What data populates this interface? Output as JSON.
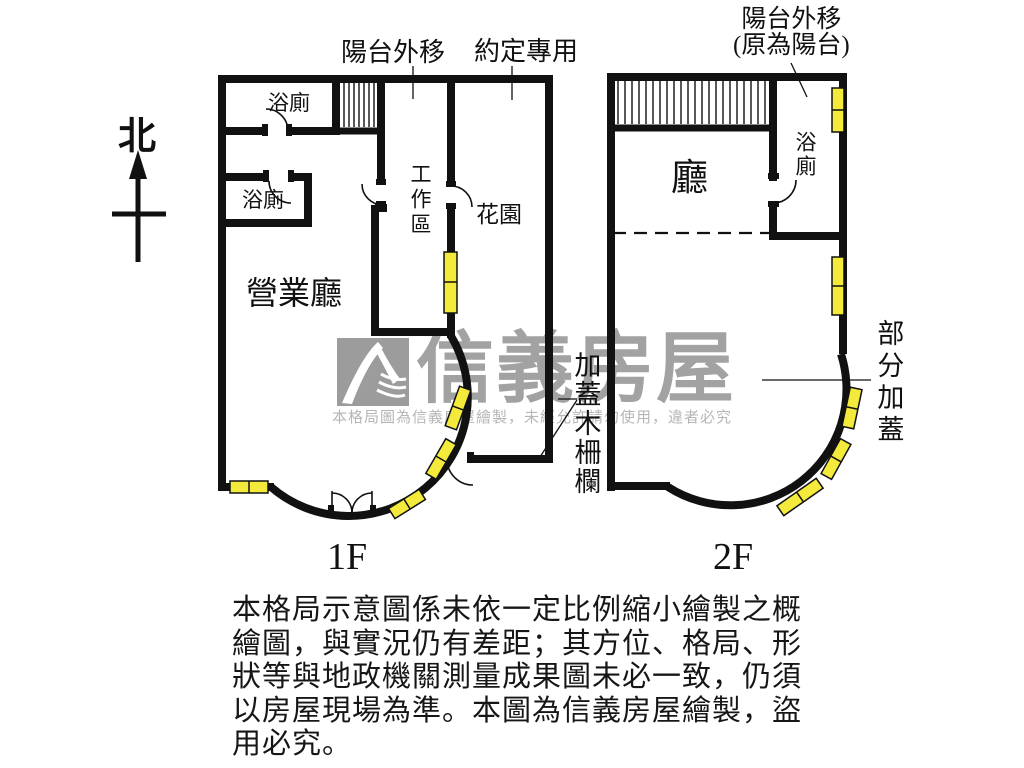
{
  "compass": {
    "north": "北"
  },
  "floor1": {
    "name": "1F",
    "annotations": {
      "balcony_out": "陽台外移",
      "agreed_use": "約定專用",
      "fence": "加蓋木柵欄"
    },
    "rooms": {
      "bath_top": "浴廁",
      "bath_mid": "浴廁",
      "work_area": "工作區",
      "garden": "花園",
      "business_hall": "營業廳"
    }
  },
  "floor2": {
    "name": "2F",
    "annotations": {
      "balcony_out_line1": "陽台外移",
      "balcony_out_line2": "(原為陽台)",
      "partial_cover": "部分加蓋"
    },
    "rooms": {
      "hall": "廳",
      "bath": "浴廁"
    }
  },
  "watermark": {
    "brand": "信義房屋",
    "notice": "本格局圖為信義房屋繪製，未經允許請勿使用，違者必究"
  },
  "disclaimer": {
    "lines": [
      "本格局示意圖係未依一定比例縮小繪製之概",
      "繪圖，與實況仍有差距；其方位、格局、形",
      "狀等與地政機關測量成果圖未必一致，仍須",
      "以房屋現場為準。本圖為信義房屋繪製，盜",
      "用必究。"
    ]
  },
  "colors": {
    "wall": "#111111",
    "window": "#f4ea3b",
    "watermark_gray": "#a2a2a2"
  }
}
